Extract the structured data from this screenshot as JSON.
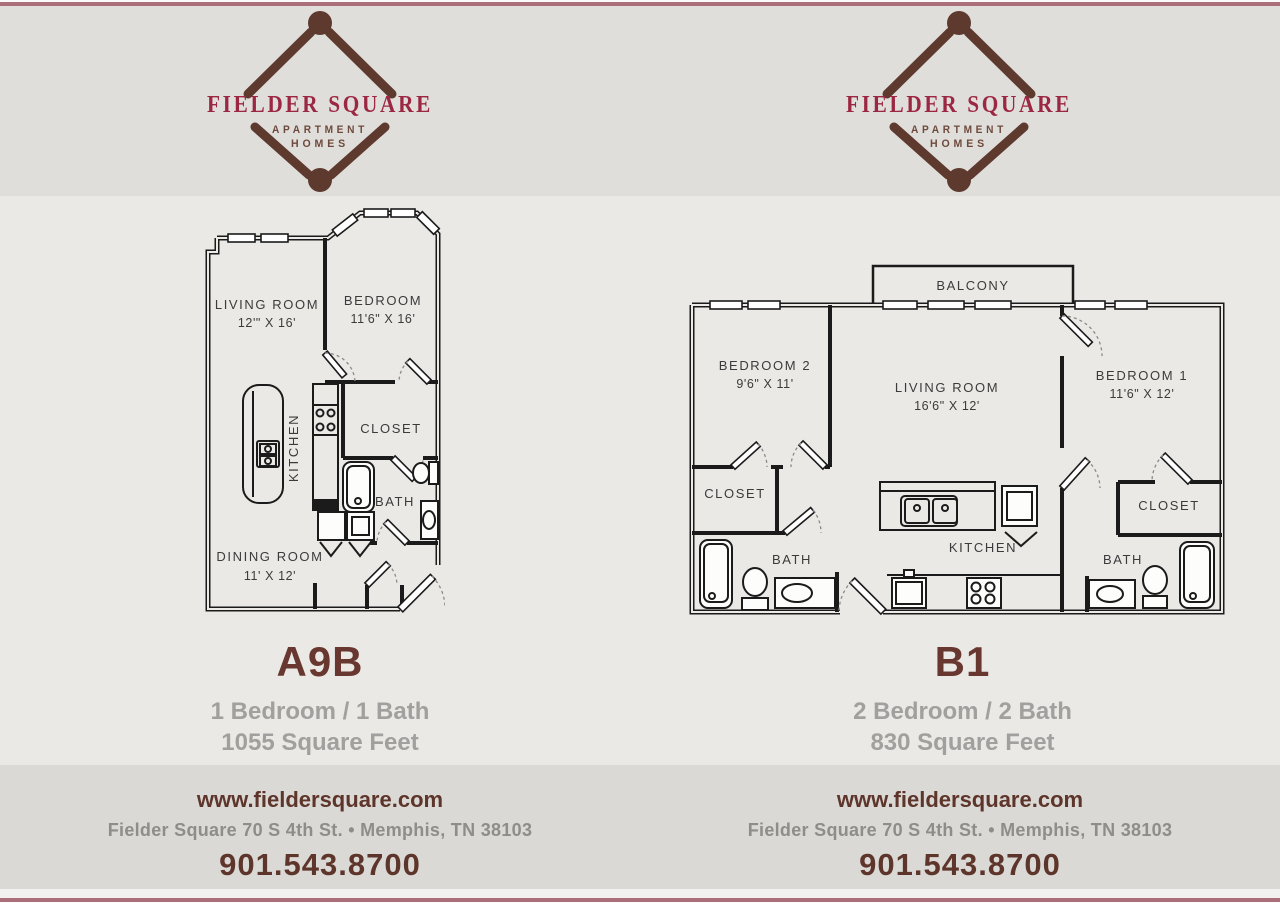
{
  "colors": {
    "accent_line": "#ab6f7c",
    "brand_crimson": "#9c2742",
    "brand_brown": "#5d392e",
    "plan_title": "#683830",
    "specs_gray": "#a1a09e"
  },
  "logo": {
    "name": "FIELDER SQUARE",
    "subtitle_line1": "APARTMENT",
    "subtitle_line2": "HOMES"
  },
  "plans": [
    {
      "title": "A9B",
      "beds_baths": "1 Bedroom / 1 Bath",
      "sqft": "1055 Square Feet",
      "rooms": {
        "living": {
          "label": "LIVING ROOM",
          "dims": "12'\" X 16'"
        },
        "bedroom": {
          "label": "BEDROOM",
          "dims": "11'6\" X 16'"
        },
        "kitchen": "KITCHEN",
        "closet": "CLOSET",
        "bath": "BATH",
        "dining": {
          "label": "DINING ROOM",
          "dims": "11' X 12'"
        }
      }
    },
    {
      "title": "B1",
      "beds_baths": "2 Bedroom / 2 Bath",
      "sqft": "830 Square Feet",
      "rooms": {
        "balcony": "BALCONY",
        "bedroom2": {
          "label": "BEDROOM 2",
          "dims": "9'6\" X 11'"
        },
        "living": {
          "label": "LIVING ROOM",
          "dims": "16'6\" X 12'"
        },
        "bedroom1": {
          "label": "BEDROOM 1",
          "dims": "11'6\" X 12'"
        },
        "closet_left": "CLOSET",
        "bath_left": "BATH",
        "kitchen": "KITCHEN",
        "closet_right": "CLOSET",
        "bath_right": "BATH"
      }
    }
  ],
  "footer": {
    "website": "www.fieldersquare.com",
    "address": "Fielder Square 70 S 4th St.  •  Memphis, TN 38103",
    "phone": "901.543.8700"
  }
}
